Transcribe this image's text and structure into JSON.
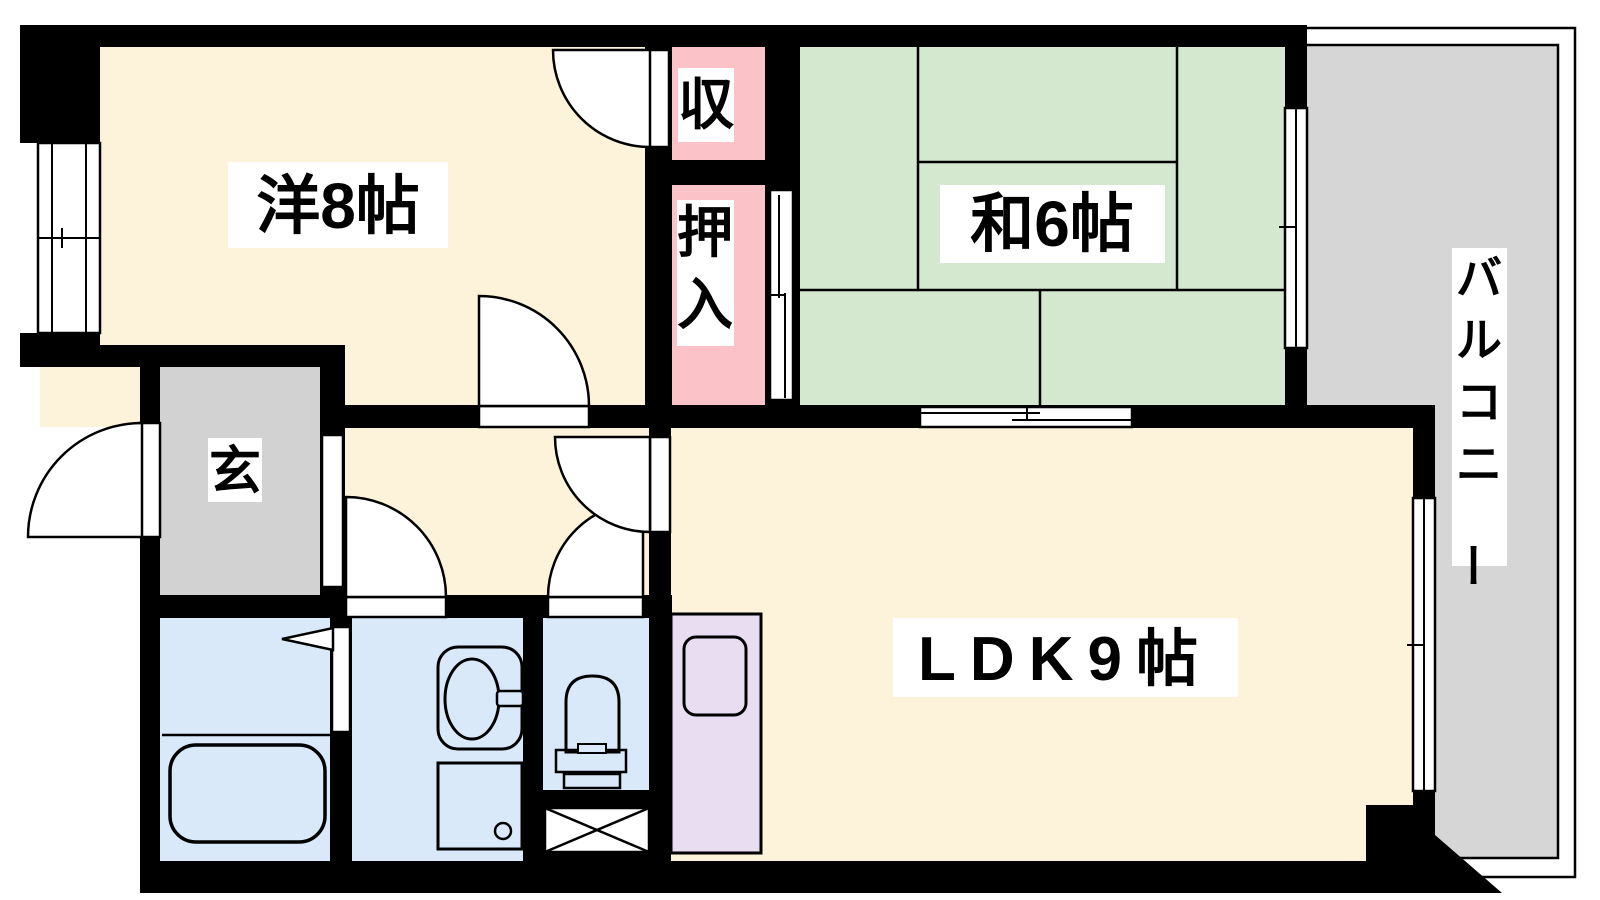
{
  "title": "1LDK apartment floor plan",
  "colors": {
    "wall": "#000000",
    "line": "#000000",
    "western_room": "#FCF3DA",
    "closet_pink": "#FBC3C8",
    "tatami_green": "#D4E7CF",
    "entrance_gray": "#D2D2D2",
    "balcony_gray": "#D6D6D6",
    "wet_blue": "#D9E9FA",
    "kitchen_purple": "#E9DDF1",
    "label_bg": "#FFFFFF"
  },
  "rooms": {
    "western": {
      "label": "洋8帖"
    },
    "storage": {
      "label": "収"
    },
    "oshiire": {
      "label": "押入"
    },
    "japanese": {
      "label": "和6帖"
    },
    "entrance": {
      "label": "玄"
    },
    "ldk": {
      "label": "LDK9帖"
    },
    "balcony": {
      "label": "バルコニー"
    }
  },
  "fixtures": [
    "bathtub-icon",
    "washbasin-icon",
    "washing-machine-pan-icon",
    "toilet-icon",
    "kitchen-sink-icon",
    "pipe-space-cross-icon",
    "door-swing-arc-icon",
    "sliding-window-icon",
    "sliding-door-icon"
  ]
}
